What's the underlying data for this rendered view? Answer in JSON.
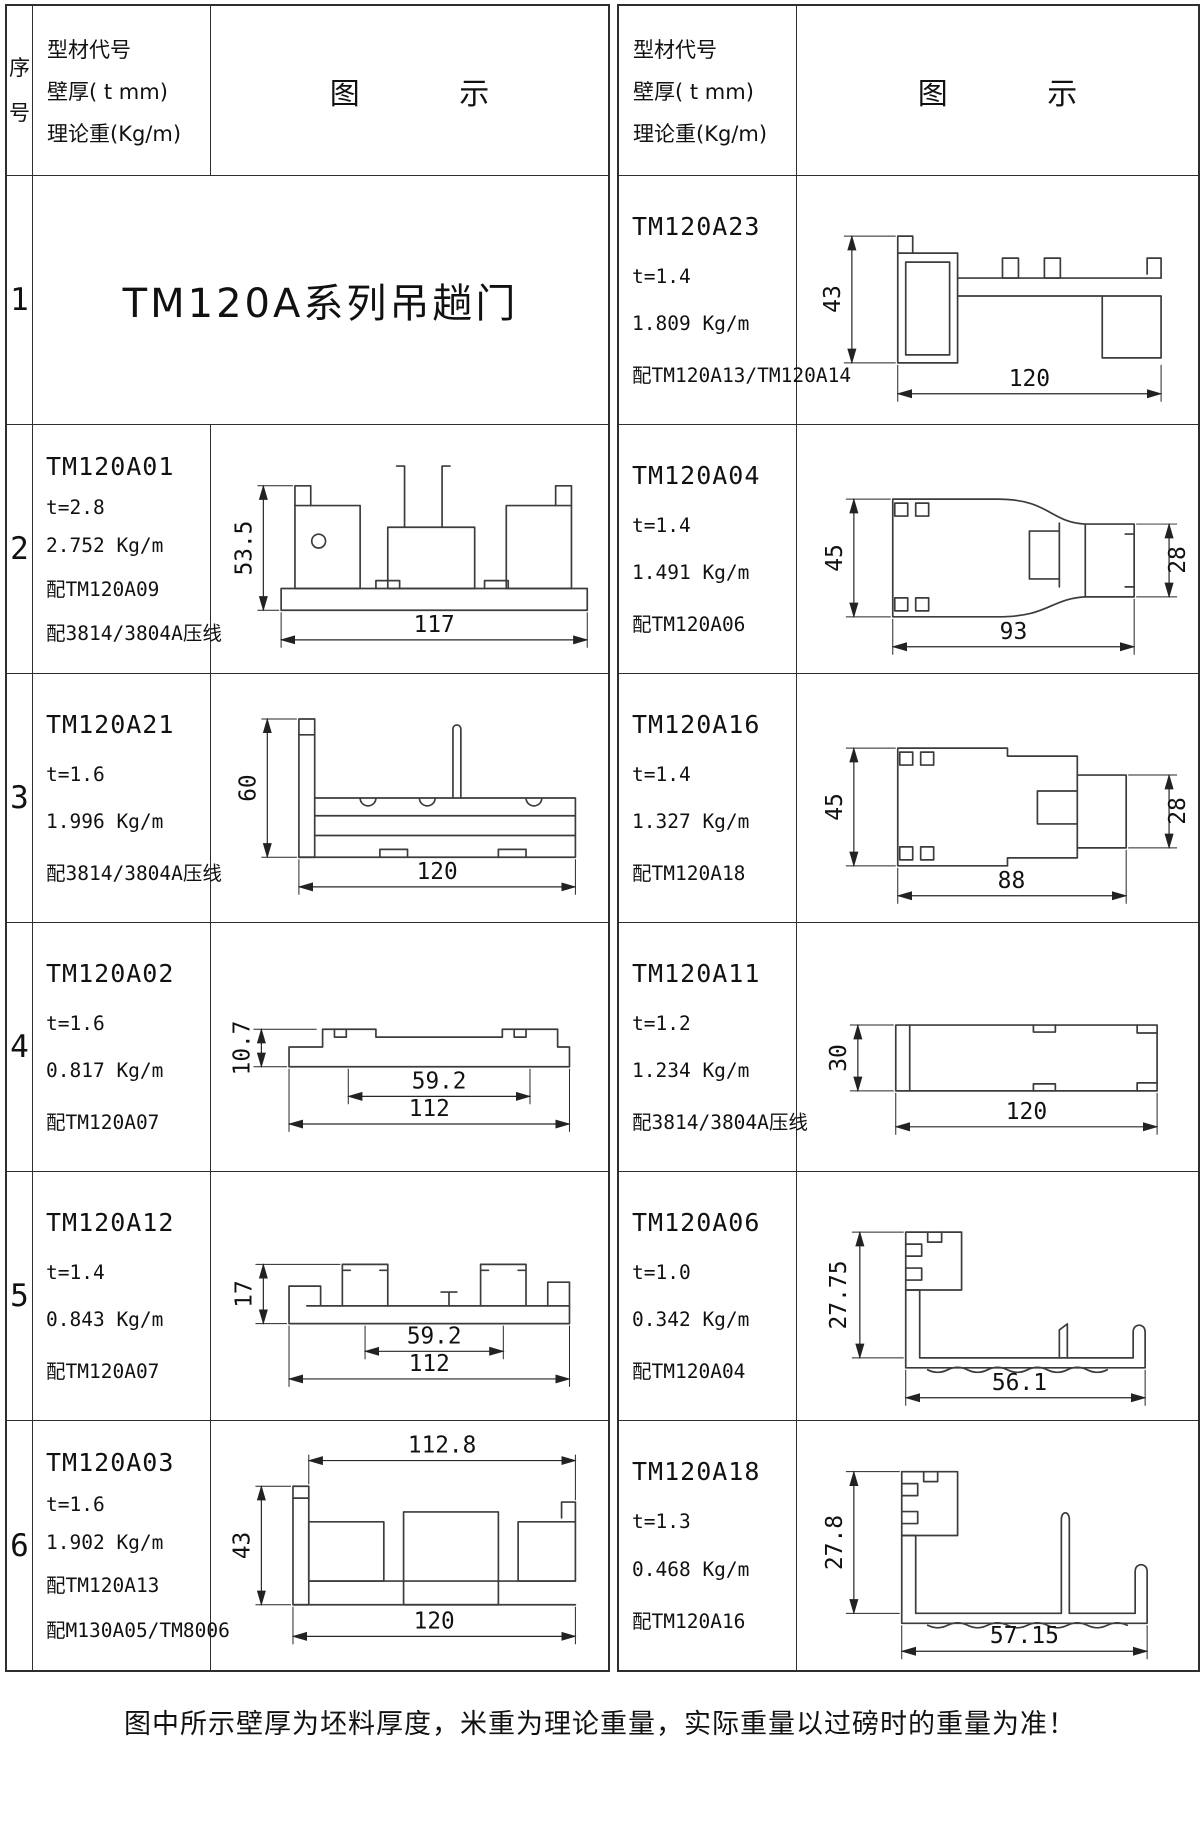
{
  "header": {
    "index": "序号",
    "spec1": "型材代号",
    "spec2": "壁厚( t mm)",
    "spec3": "理论重(Kg/m)",
    "diagram": "图 示"
  },
  "note": "图中所示壁厚为坯料厚度，米重为理论重量，实际重量以过磅时的重量为准！",
  "left": {
    "rows": [
      {
        "index": "1",
        "title": "TM120A系列吊趟门"
      },
      {
        "index": "2",
        "code": "TM120A01",
        "thickness": "t=2.8",
        "weight": "2.752 Kg/m",
        "pair1": "配TM120A09",
        "pair2": "配3814/3804A压线",
        "dims": {
          "h": "53.5",
          "w": "117"
        }
      },
      {
        "index": "3",
        "code": "TM120A21",
        "thickness": "t=1.6",
        "weight": "1.996 Kg/m",
        "pair1": "配3814/3804A压线",
        "dims": {
          "h": "60",
          "w": "120"
        }
      },
      {
        "index": "4",
        "code": "TM120A02",
        "thickness": "t=1.6",
        "weight": "0.817 Kg/m",
        "pair1": "配TM120A07",
        "dims": {
          "h": "10.7",
          "inner": "59.2",
          "w": "112"
        }
      },
      {
        "index": "5",
        "code": "TM120A12",
        "thickness": "t=1.4",
        "weight": "0.843 Kg/m",
        "pair1": "配TM120A07",
        "dims": {
          "h": "17",
          "inner": "59.2",
          "w": "112"
        }
      },
      {
        "index": "6",
        "code": "TM120A03",
        "thickness": "t=1.6",
        "weight": "1.902 Kg/m",
        "pair1": "配TM120A13",
        "pair2": "配M130A05/TM8006",
        "dims": {
          "top": "112.8",
          "h": "43",
          "w": "120"
        }
      }
    ]
  },
  "right": {
    "rows": [
      {
        "code": "TM120A23",
        "thickness": "t=1.4",
        "weight": "1.809 Kg/m",
        "pair1": "配TM120A13/TM120A14",
        "dims": {
          "h": "43",
          "w": "120"
        }
      },
      {
        "code": "TM120A04",
        "thickness": "t=1.4",
        "weight": "1.491 Kg/m",
        "pair1": "配TM120A06",
        "dims": {
          "h": "45",
          "h2": "28",
          "w": "93"
        }
      },
      {
        "code": "TM120A16",
        "thickness": "t=1.4",
        "weight": "1.327 Kg/m",
        "pair1": "配TM120A18",
        "dims": {
          "h": "45",
          "h2": "28",
          "w": "88"
        }
      },
      {
        "code": "TM120A11",
        "thickness": "t=1.2",
        "weight": "1.234 Kg/m",
        "pair1": "配3814/3804A压线",
        "dims": {
          "h": "30",
          "w": "120"
        }
      },
      {
        "code": "TM120A06",
        "thickness": "t=1.0",
        "weight": "0.342 Kg/m",
        "pair1": "配TM120A04",
        "dims": {
          "h": "27.75",
          "w": "56.1"
        }
      },
      {
        "code": "TM120A18",
        "thickness": "t=1.3",
        "weight": "0.468 Kg/m",
        "pair1": "配TM120A16",
        "dims": {
          "h": "27.8",
          "w": "57.15"
        }
      }
    ]
  }
}
